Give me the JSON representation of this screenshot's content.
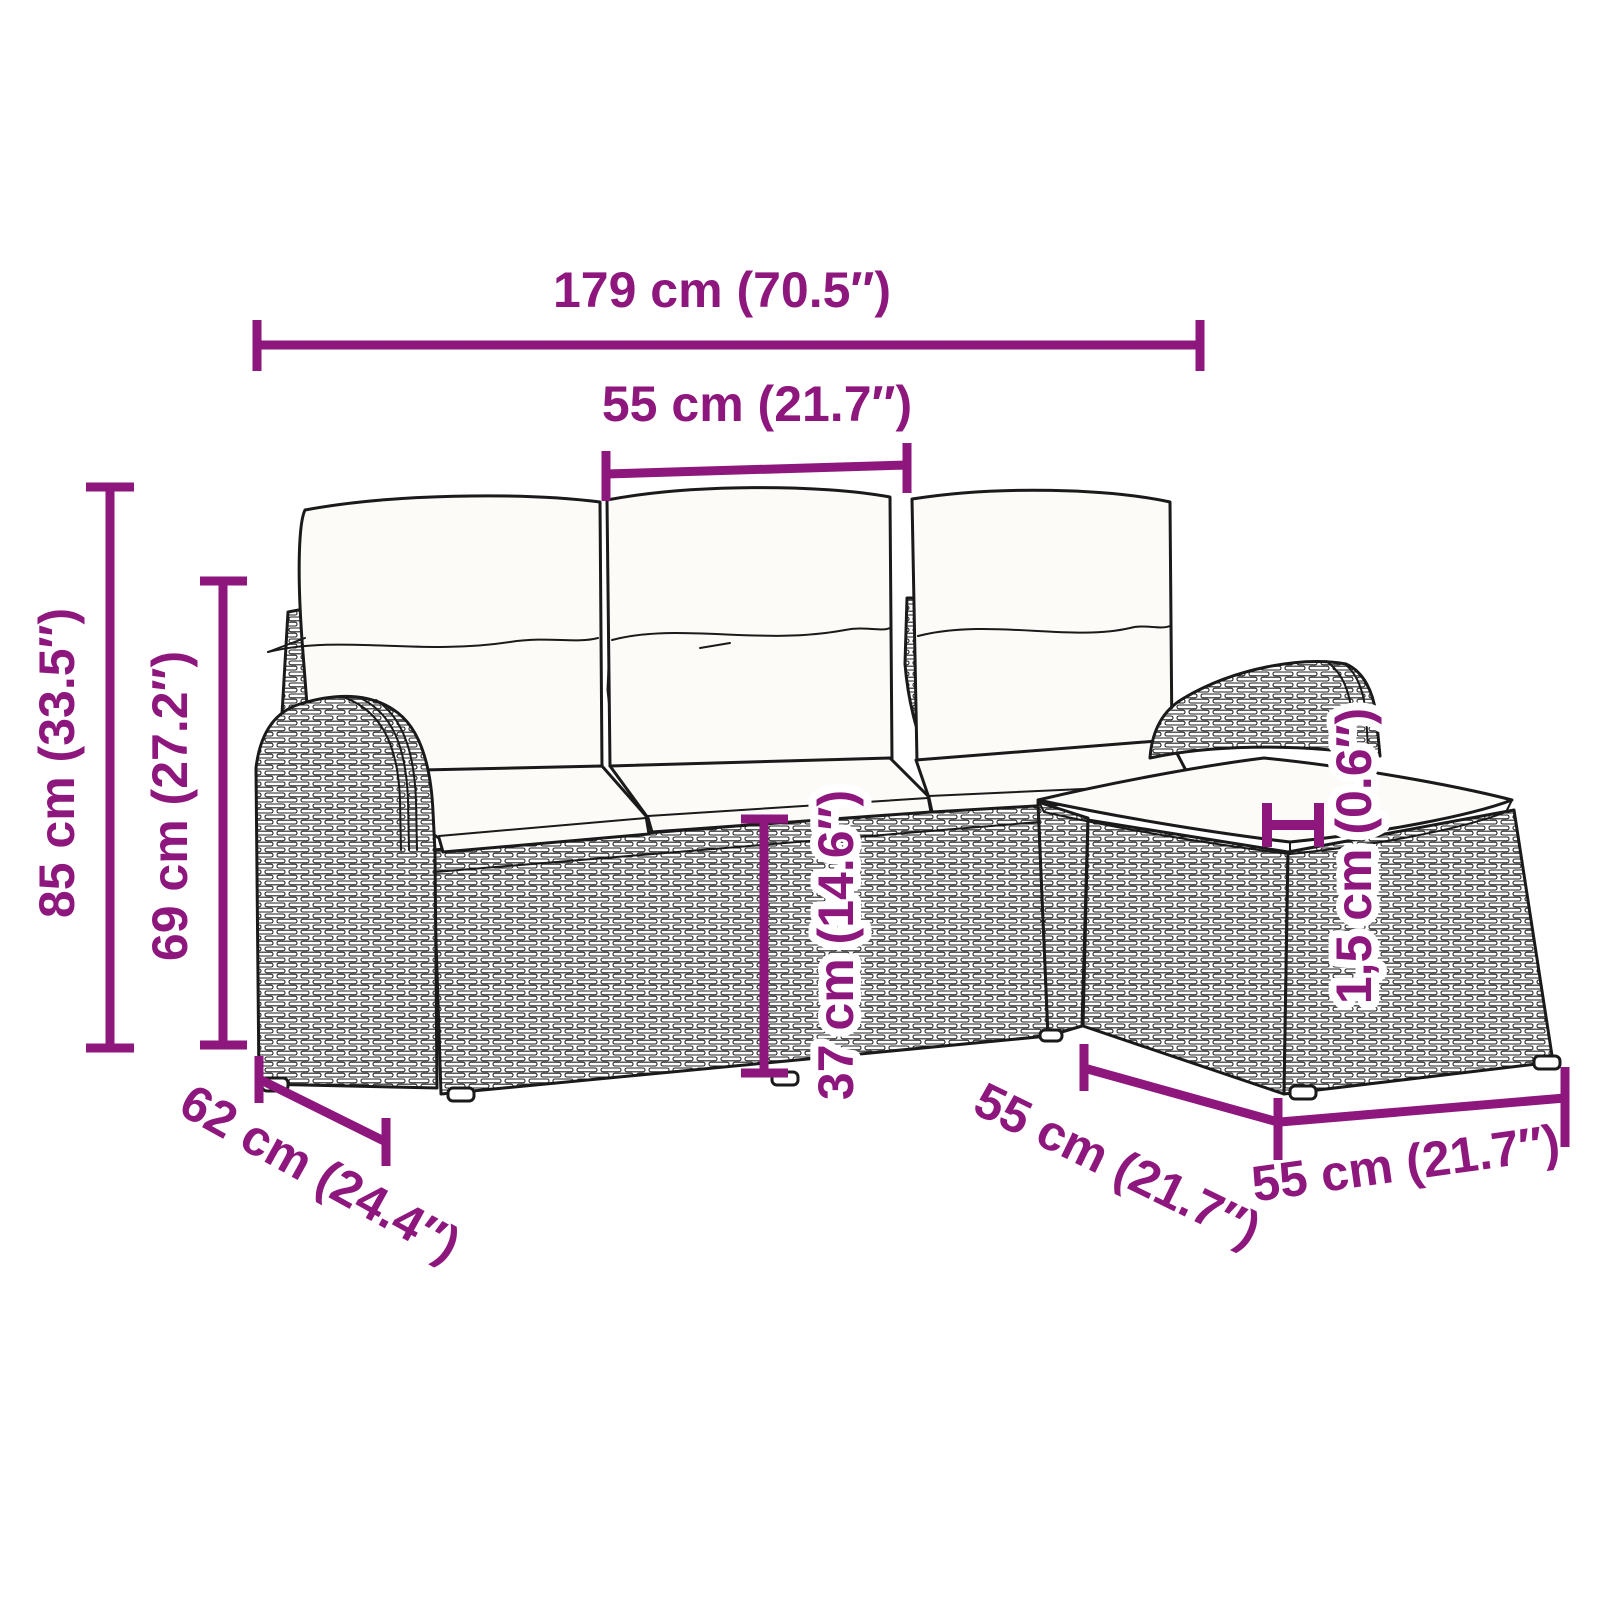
{
  "diagram": {
    "type": "furniture-dimension-diagram",
    "subject": "poly rattan garden sofa set: 3-seater sofa with back cushions and footstool with cushion",
    "accent_color": "#8e177e",
    "line_art_color": "#1a1a1a",
    "background_color": "#ffffff",
    "labels": {
      "overall_width": "179 cm (70.5″)",
      "seat_module_width": "55 cm (21.7″)",
      "overall_height": "85 cm (33.5″)",
      "backrest_height": "69 cm (27.2″)",
      "seat_depth": "62 cm (24.4″)",
      "seat_height": "37 cm (14.6″)",
      "cushion_thickness": "1,5 cm (0.6″)",
      "stool_front_width": "55 cm (21.7″)",
      "stool_side_width": "55 cm (21.7″)"
    }
  }
}
